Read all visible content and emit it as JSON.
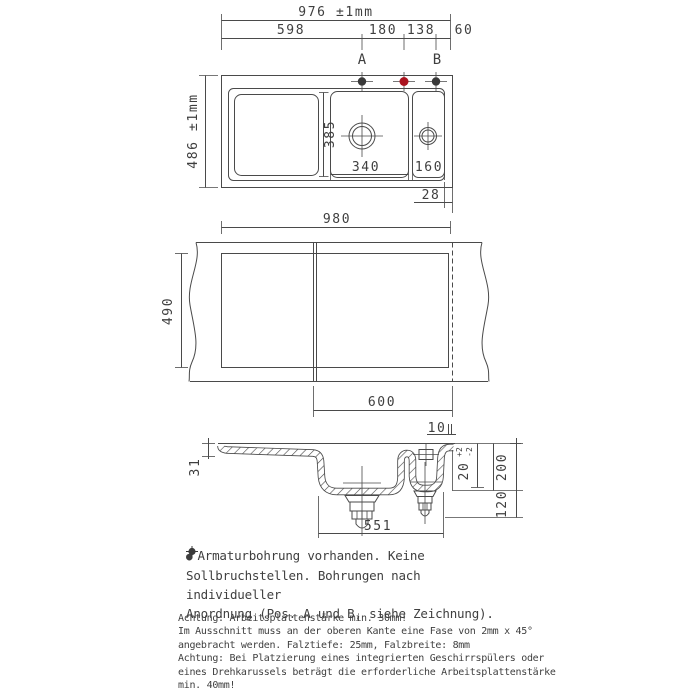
{
  "top_view": {
    "dim_overall_width": "976 ±1mm",
    "dim_seg_1": "598",
    "dim_seg_2": "180",
    "dim_seg_3": "138",
    "dim_seg_4": "60",
    "hole_a_label": "A",
    "hole_b_label": "B",
    "dim_overall_depth": "486 ±1mm",
    "dim_main_bowl_depth": "385",
    "dim_main_bowl_width": "340",
    "dim_small_bowl_width": "160",
    "dim_rear_edge": "28"
  },
  "cutout_view": {
    "dim_width": "980",
    "dim_depth": "490",
    "dim_offset": "600"
  },
  "section_view": {
    "dim_gap": "10",
    "dim_front": "31",
    "dim_rim": "20",
    "dim_rim_plus": "+2",
    "dim_rim_minus": "-2",
    "dim_depth_total": "200",
    "dim_below": "120",
    "dim_bowl_span": "551"
  },
  "icons": {
    "bullet": "●"
  },
  "colors": {
    "line": "#4a4a4a",
    "hole_fixed": "#3a3a3a",
    "hole_optional": "#ab1420"
  },
  "notes": {
    "bullet_note": {
      "line1": "Armaturbohrung vorhanden. Keine",
      "line2": "Sollbruchstellen. Bohrungen nach individueller",
      "line3_prefix": "Anordnung (",
      "line3_suffix": "Pos. A und B, siehe Zeichnung)."
    },
    "warnings": {
      "lines": [
        "Achtung: Arbeitsplattenstärke min. 30mm!",
        "Im Ausschnitt muss an der oberen Kante eine Fase von 2mm x 45°",
        "angebracht werden. Falztiefe: 25mm, Falzbreite: 8mm",
        "Achtung: Bei Platzierung eines integrierten Geschirrspülers oder",
        "eines Drehkarussels beträgt die erforderliche Arbeitsplattenstärke",
        "min. 40mm!"
      ]
    }
  }
}
